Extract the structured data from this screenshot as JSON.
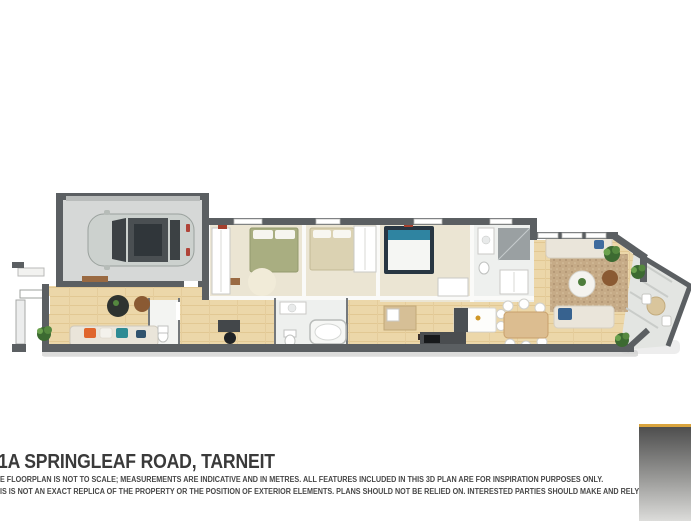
{
  "header": {
    "title": "1A SPRINGLEAF ROAD, TARNEIT"
  },
  "disclaimer": {
    "line1": "E FLOORPLAN IS NOT TO SCALE; MEASUREMENTS ARE INDICATIVE AND IN METRES. ALL FEATURES INCLUDED IN THIS 3D PLAN ARE FOR INSPIRATION PURPOSES ONLY.",
    "line2": "IS IS NOT AN EXACT REPLICA OF THE PROPERTY OR THE POSITION OF EXTERIOR ELEMENTS. PLANS SHOULD NOT BE RELIED ON. INTERESTED PARTIES SHOULD MAKE AND RELY ON THEIR OWN ENQUI"
  },
  "branding_corner": {
    "accent": "#d9a43e",
    "gradient_top": "#4e4e4e",
    "gradient_bottom": "#dcdcda"
  },
  "floorplan": {
    "colors": {
      "wall": "#5b5f62",
      "wood_floor": "#ecd7a9",
      "carpet": "#ebe5d3",
      "garage_floor": "#d6d8d7",
      "bath_floor": "#eef0ee",
      "deck": "#e3e5e2",
      "rug": "#c6ab87",
      "bed_olive": "#a9ae81",
      "bed_cream": "#dbd2b2",
      "bed_teal": "#2f84a1",
      "sofa_cream": "#eae5da",
      "cushion_orange": "#e0662d",
      "cushion_teal": "#2e8b94",
      "cushion_navy": "#31536e",
      "plant_green": "#55883f",
      "car_body": "#ccd1ce",
      "car_glass": "#3c4144",
      "doormat_brown": "#9a6a42",
      "dining_table_wood": "#dcbd90",
      "kitchen_bench_dark": "#4a4d50"
    },
    "objects": [
      "garage",
      "car",
      "entry-porch",
      "lounge",
      "sofa",
      "coffee-table",
      "home-office-desk",
      "bedroom-1",
      "bedroom-2",
      "bedroom-3",
      "ensuite-shower",
      "bathroom",
      "bathtub",
      "toilet",
      "laundry-bench",
      "kitchen-island",
      "kitchen-bench",
      "dining-table",
      "family-room",
      "rug",
      "alfresco-deck",
      "outdoor-setting",
      "plants"
    ]
  }
}
